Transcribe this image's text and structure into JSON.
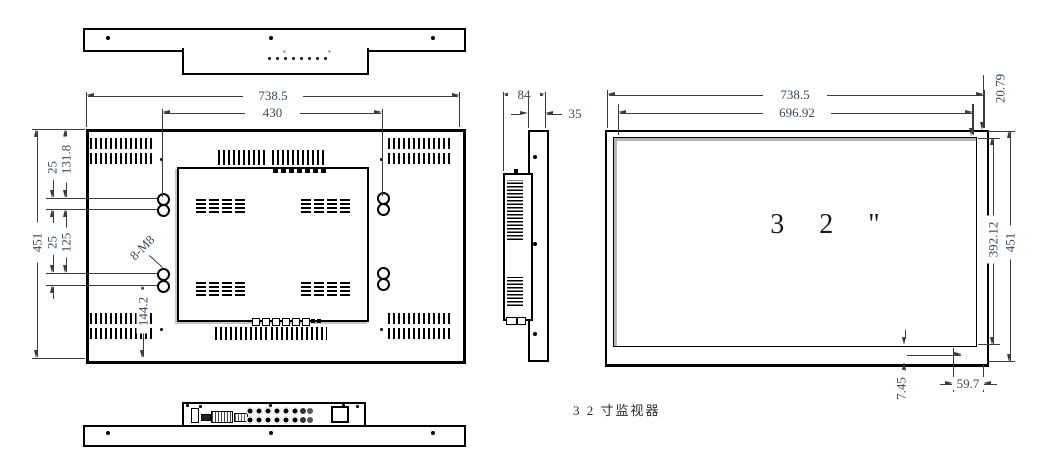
{
  "drawing": {
    "caption": "3 2 寸监视器",
    "rear_view": {
      "width": "738.5",
      "vesa_width": "430",
      "height": "451",
      "top_to_hole": "131.8",
      "hole_pitch_upper": "25",
      "hole_span": "125",
      "hole_pitch_lower": "25",
      "hole_to_bottom": "144.2",
      "mount_holes": "8-M8"
    },
    "side_view": {
      "depth": "84",
      "panel_depth": "35"
    },
    "front_view": {
      "width": "738.5",
      "screen_width": "696.92",
      "bezel_top": "20.79",
      "screen_height": "392.12",
      "height": "451",
      "bezel_bottom": "7.45",
      "corner_offset": "59.7",
      "size_label": "3 2 \""
    }
  }
}
